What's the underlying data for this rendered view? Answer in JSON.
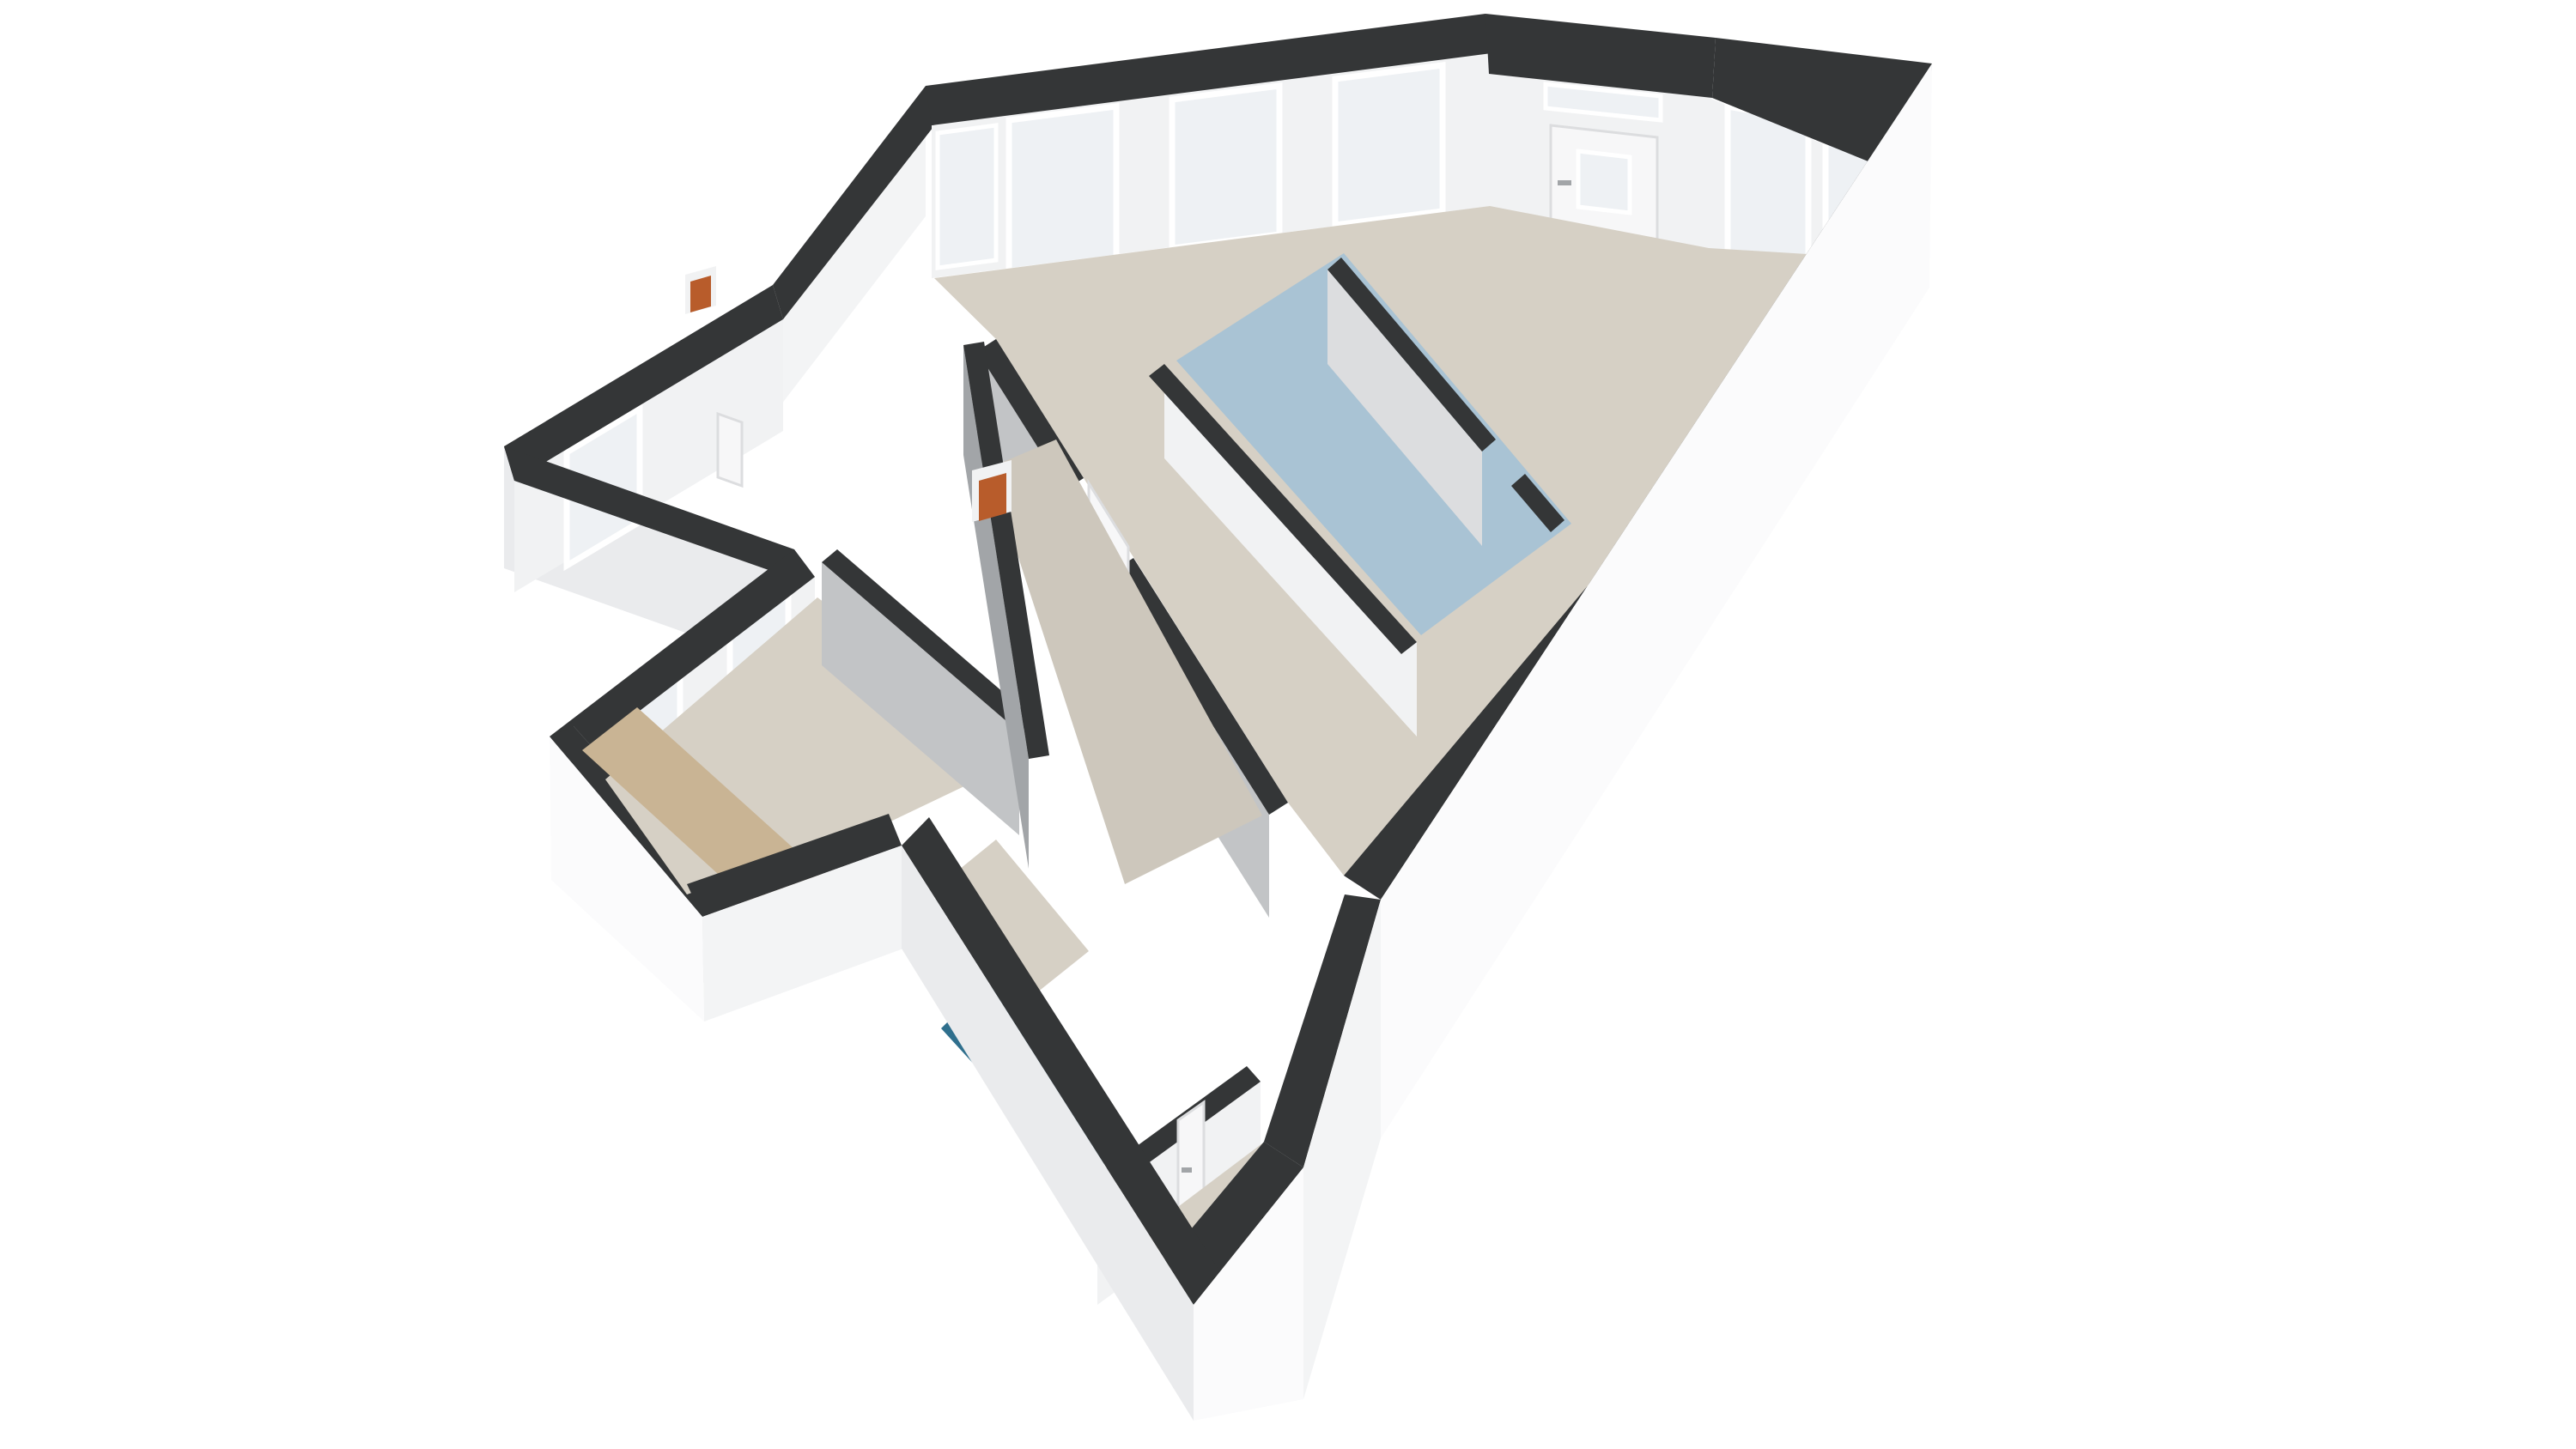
{
  "scene": {
    "kind": "floorplan-3d-render",
    "view": "axonometric-birdseye",
    "building_shape": "bent-L apartment volume with lower side wing",
    "background": "#ffffff"
  },
  "palette": {
    "wall_top": "#343637",
    "outer_wall_bright": "#fbfbfc",
    "outer_wall_light": "#f3f4f5",
    "outer_wall_shade": "#eaebed",
    "inner_wall_white": "#f1f2f3",
    "inner_wall_light": "#dcdddf",
    "inner_wall_gray": "#c2c4c6",
    "inner_wall_dark": "#a2a5a8",
    "floor_main": "#d6d0c5",
    "floor_secondary": "#cdc7bc",
    "floor_kitchen_blue": "#a9c3d4",
    "floor_bathroom_teal": "#2f6f8d",
    "floor_hall_tan": "#c9b494",
    "window_glass": "#eef1f4",
    "window_frame": "#ffffff",
    "door_white": "#f7f7f8",
    "accent_orange": "#b85c2b"
  },
  "rooms": [
    {
      "name": "living-room",
      "floor_color_key": "floor_main"
    },
    {
      "name": "kitchen-area",
      "floor_color_key": "floor_kitchen_blue"
    },
    {
      "name": "hallway",
      "floor_color_key": "floor_main"
    },
    {
      "name": "bedroom",
      "floor_color_key": "floor_main"
    },
    {
      "name": "entrance-hall",
      "floor_color_key": "floor_hall_tan"
    },
    {
      "name": "bathroom",
      "floor_color_key": "floor_bathroom_teal"
    },
    {
      "name": "rear-room",
      "floor_color_key": "floor_main"
    }
  ],
  "features": {
    "window_count": 9,
    "exterior_door_count": 2,
    "interior_door_count": 4,
    "corner_door_has_transom": true,
    "boiler_unit_count": 2
  }
}
